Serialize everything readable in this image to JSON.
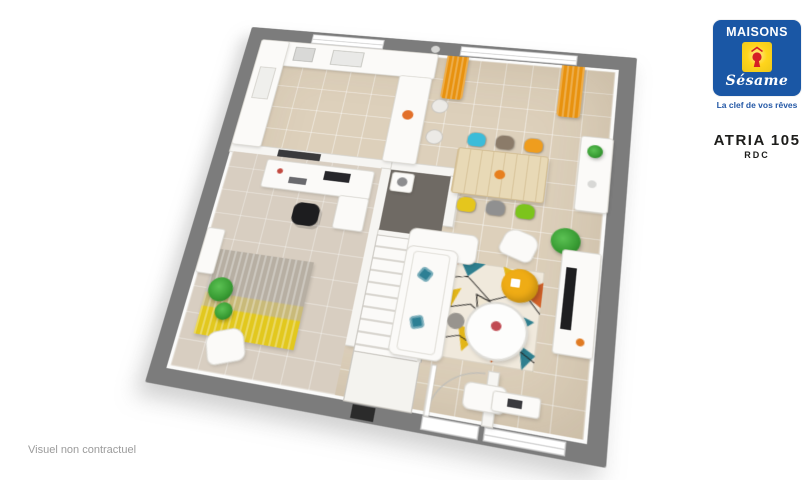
{
  "logo": {
    "brand_top": "MAISONS",
    "brand_script": "Sésame",
    "tagline": "La clef de vos rêves",
    "colors": {
      "blue": "#1a57a5",
      "yellow": "#ffd51c",
      "red": "#d51f26",
      "tagline_blue": "#2458a6"
    }
  },
  "title": {
    "model": "ATRIA 105",
    "level": "RDC"
  },
  "footer": {
    "disclaimer": "Visuel non contractuel"
  },
  "floorplan": {
    "wall_color": "#7c7c7c",
    "floor_color": "#ddd0bb",
    "office_floor_color": "#d8cec1",
    "storage_floor_color": "#6f6a64",
    "curtain_color": "#e8920f",
    "dining_chairs": [
      "#3cbcd9",
      "#8b7b69",
      "#ef9d1e",
      "#e5c61d",
      "#909090",
      "#7cc41c"
    ],
    "pouf_color": "#efac15",
    "plant_color": "#3a9e35",
    "rug_palette": [
      "#f0e9dc",
      "#d2622a",
      "#2e7f8f",
      "#e3b619",
      "#23211f"
    ]
  }
}
